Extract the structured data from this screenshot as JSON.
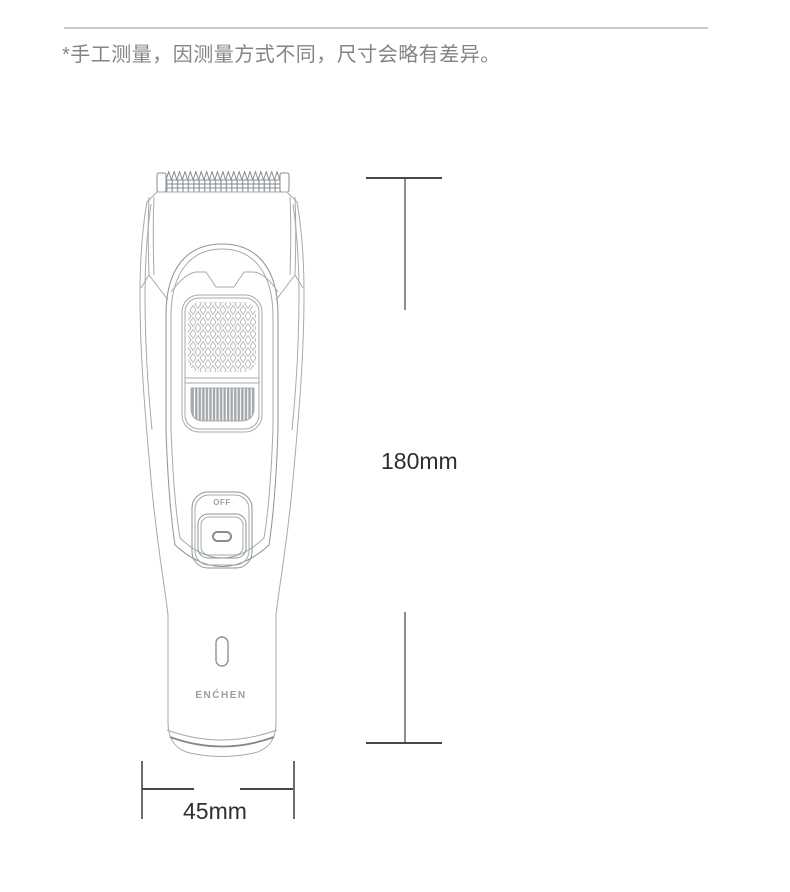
{
  "note": "*手工测量，因测量方式不同，尺寸会略有差异。",
  "product": {
    "brand_label": "ENĆHEN",
    "power_button_label": "OFF"
  },
  "dimensions": {
    "height_label": "180mm",
    "width_label": "45mm"
  },
  "colors": {
    "divider": "#cbcbcb",
    "note_text": "#848484",
    "dimension_tick": "#474747",
    "dimension_line": "#8e8e8e",
    "dimension_text": "#2f2f2f",
    "art_line_light": "#a4aaae",
    "art_line_dark": "#858b90",
    "brand_text": "#989ea3"
  }
}
